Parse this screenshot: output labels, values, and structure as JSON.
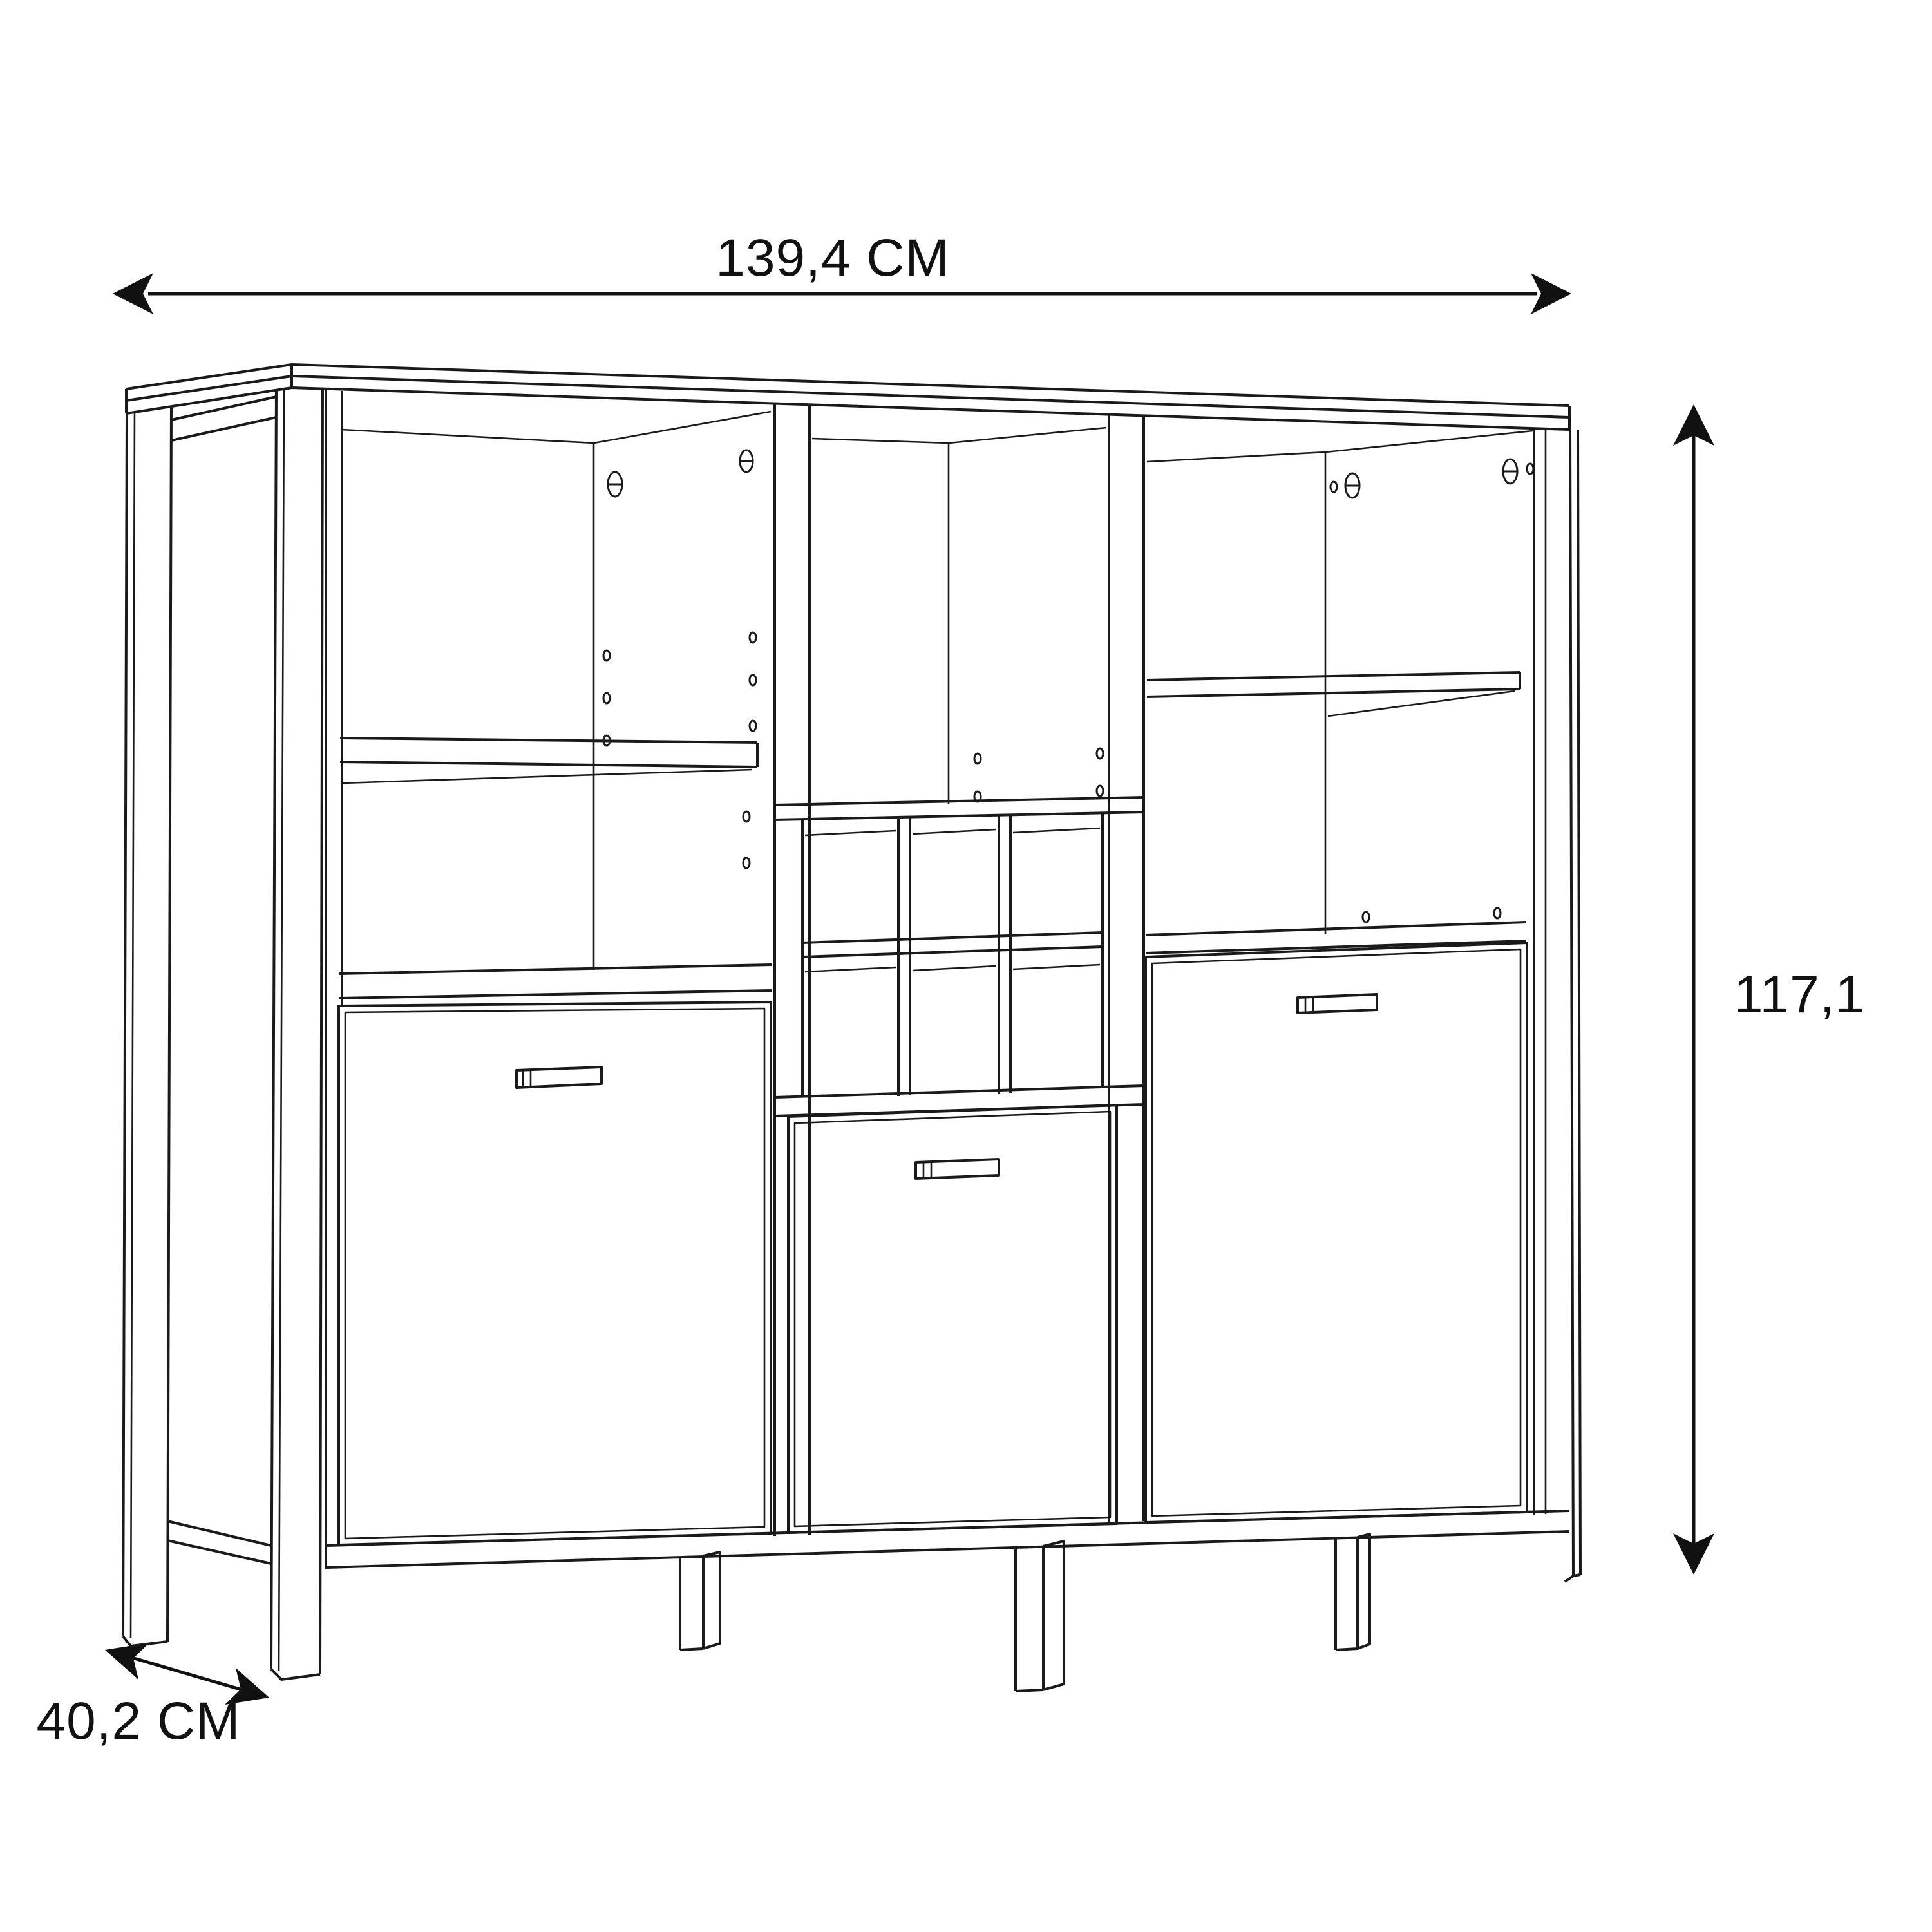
{
  "drawing": {
    "kind": "furniture-technical-dimension-diagram",
    "object": "highboard cabinet line drawing with three doors, open shelf compartments and wine-rack cubes",
    "dimensions": {
      "width": {
        "value": "139,4",
        "unit": "CM",
        "label": "139,4 CM"
      },
      "height": {
        "value": "117,1",
        "unit": "",
        "label": "117,1"
      },
      "depth": {
        "value": "40,2",
        "unit": "CM",
        "label": "40,2 CM"
      }
    },
    "colors": {
      "background": "#ffffff",
      "line": "#1a1a1a",
      "dimension": "#111111"
    },
    "icons": {
      "width_arrow": "double-headed-horizontal-arrow",
      "height_arrow": "double-headed-vertical-arrow",
      "depth_arrow": "double-headed-diagonal-arrow"
    }
  }
}
